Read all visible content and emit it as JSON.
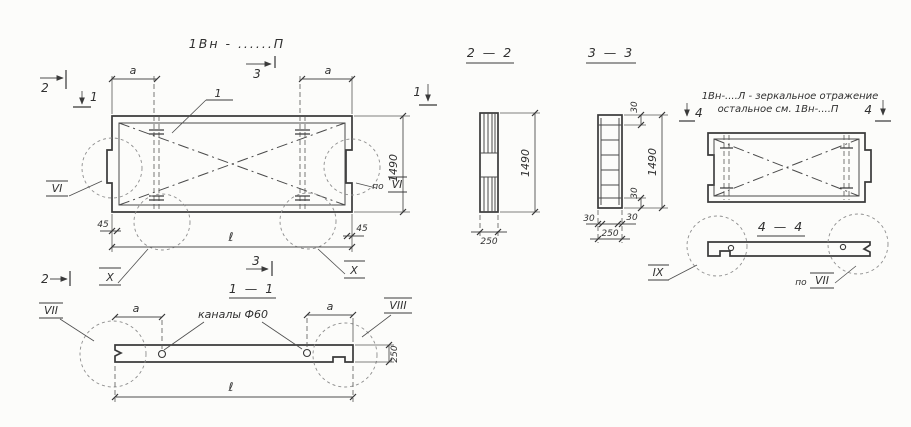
{
  "palette": {
    "paper": "#fcfcfa",
    "ink": "#3a3a3a",
    "dim_lines": "#4e4e4e",
    "faint": "#8e8e8e"
  },
  "titles": {
    "main": "1Вн - ......П",
    "s11": "1 — 1",
    "s22": "2 — 2",
    "s33": "3 — 3",
    "s44": "4 — 4"
  },
  "note": {
    "line1": "1Вн-....Л - зеркальное отражение",
    "line2": "остальное   см.  1Вн-....П"
  },
  "marks": {
    "m1": "1",
    "m2": "2",
    "m3": "3",
    "m4": "4"
  },
  "details": {
    "po": "по",
    "vi": "VI",
    "vii": "VII",
    "viii": "VIII",
    "ix": "IX",
    "x": "X"
  },
  "dims": {
    "a": "a",
    "el": "ℓ",
    "d45": "45",
    "d250": "250",
    "d1490": "1490",
    "d30": "30"
  },
  "callouts": {
    "channels": "каналы Ф60",
    "pos1": "1"
  }
}
